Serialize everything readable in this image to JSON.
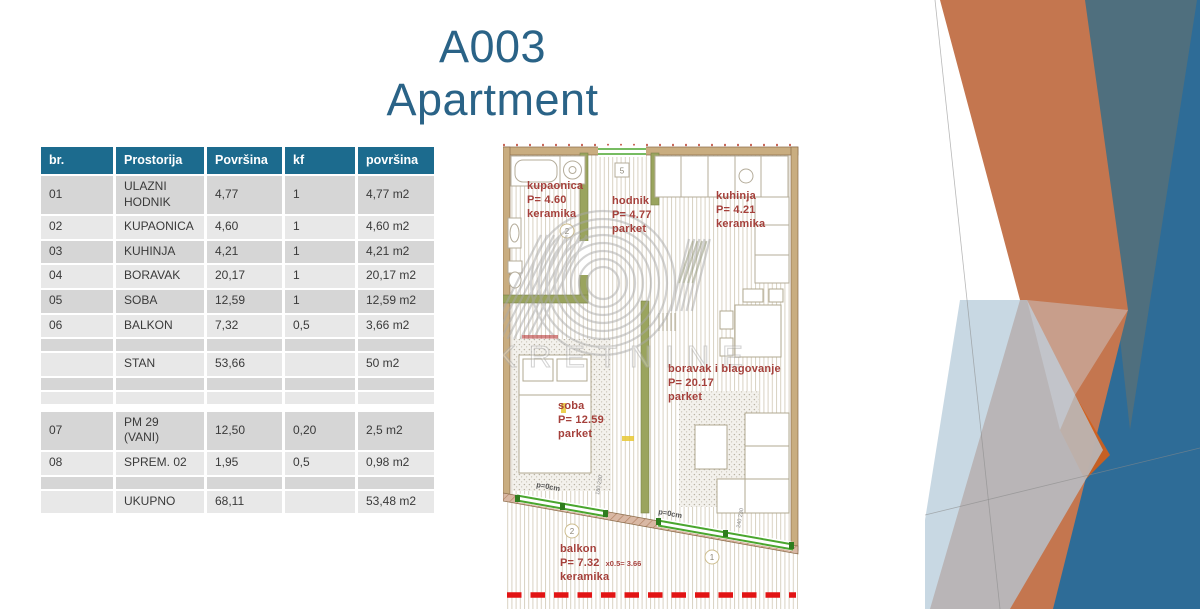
{
  "slide": {
    "title_line1": "A003",
    "title_line2": "Apartment"
  },
  "table": {
    "columns": [
      "br.",
      "Prostorija",
      "Površina",
      "kf",
      "površina"
    ],
    "rows": [
      {
        "cells": [
          "01",
          "ULAZNI HODNIK",
          "4,77",
          "1",
          "4,77 m2"
        ],
        "band": "a"
      },
      {
        "cells": [
          "02",
          "KUPAONICA",
          "4,60",
          "1",
          "4,60 m2"
        ],
        "band": "b"
      },
      {
        "cells": [
          "03",
          "KUHINJA",
          "4,21",
          "1",
          "4,21 m2"
        ],
        "band": "a"
      },
      {
        "cells": [
          "04",
          "BORAVAK",
          "20,17",
          "1",
          "20,17 m2"
        ],
        "band": "b"
      },
      {
        "cells": [
          "05",
          "SOBA",
          "12,59",
          "1",
          "12,59 m2"
        ],
        "band": "a"
      },
      {
        "cells": [
          "06",
          "BALKON",
          "7,32",
          "0,5",
          "3,66 m2"
        ],
        "band": "b"
      },
      {
        "cells": [
          "",
          "",
          "",
          "",
          ""
        ],
        "band": "a"
      },
      {
        "cells": [
          "",
          "STAN",
          "53,66",
          "",
          "50 m2"
        ],
        "band": "b"
      },
      {
        "cells": [
          "",
          "",
          "",
          "",
          ""
        ],
        "band": "a"
      },
      {
        "cells": [
          "",
          "",
          "",
          "",
          ""
        ],
        "band": "b"
      },
      {
        "spacer": true
      },
      {
        "cells": [
          "07",
          "PM 29 (VANI)",
          "12,50",
          "0,20",
          "2,5 m2"
        ],
        "band": "a"
      },
      {
        "cells": [
          "08",
          "SPREM. 02",
          "1,95",
          "0,5",
          "0,98 m2"
        ],
        "band": "b"
      },
      {
        "cells": [
          "",
          "",
          "",
          "",
          ""
        ],
        "band": "a"
      },
      {
        "cells": [
          "",
          "UKUPNO",
          "68,11",
          "",
          "53,48 m2"
        ],
        "band": "b"
      }
    ]
  },
  "floorplan": {
    "labels": [
      {
        "name": "kupaonica",
        "x": 24,
        "y": 37,
        "lines": [
          "kupaonica",
          "P= 4.60",
          "keramika"
        ]
      },
      {
        "name": "hodnik",
        "x": 109,
        "y": 52,
        "lines": [
          "hodnik",
          "P= 4.77",
          "parket"
        ]
      },
      {
        "name": "kuhinja",
        "x": 213,
        "y": 47,
        "lines": [
          "kuhinja",
          "P= 4.21",
          "keramika"
        ]
      },
      {
        "name": "soba",
        "x": 55,
        "y": 257,
        "lines": [
          "soba",
          "P= 12.59",
          "parket"
        ]
      },
      {
        "name": "boravak-i-blagovanje",
        "x": 165,
        "y": 220,
        "lines": [
          "boravak i blagovanje",
          "P= 20.17",
          "parket"
        ]
      },
      {
        "name": "balkon",
        "x": 57,
        "y": 400,
        "lines": [
          "balkon",
          "P= 7.32",
          "keramika"
        ],
        "note": "x0.5=  3.66",
        "note_line": 1
      }
    ],
    "edge_labels": [
      {
        "text": "p=0cm"
      },
      {
        "text": "p=0cm"
      }
    ],
    "markers": {
      "box": "5",
      "circles": [
        "2",
        "2",
        "1"
      ]
    },
    "watermark": {
      "word": "NEKRETNINE"
    }
  },
  "colors": {
    "title": "#2a6387",
    "header_bg": "#1c6b8e",
    "row_band_dark": "#d6d6d6",
    "row_band_light": "#e8e8e8",
    "plan_label_red": "#a5403b",
    "wall_tan": "#c9ad80",
    "wall_olive": "#9aa45e",
    "door_green": "#4aa62e",
    "dashed_red": "#e21414",
    "deco_orange": "#c4764f",
    "deco_bright_orange": "#d2601a",
    "deco_steel_blue": "#2e6c97",
    "deco_slate": "#4f6f7e",
    "deco_pale_blue": "#b6cbd9"
  }
}
